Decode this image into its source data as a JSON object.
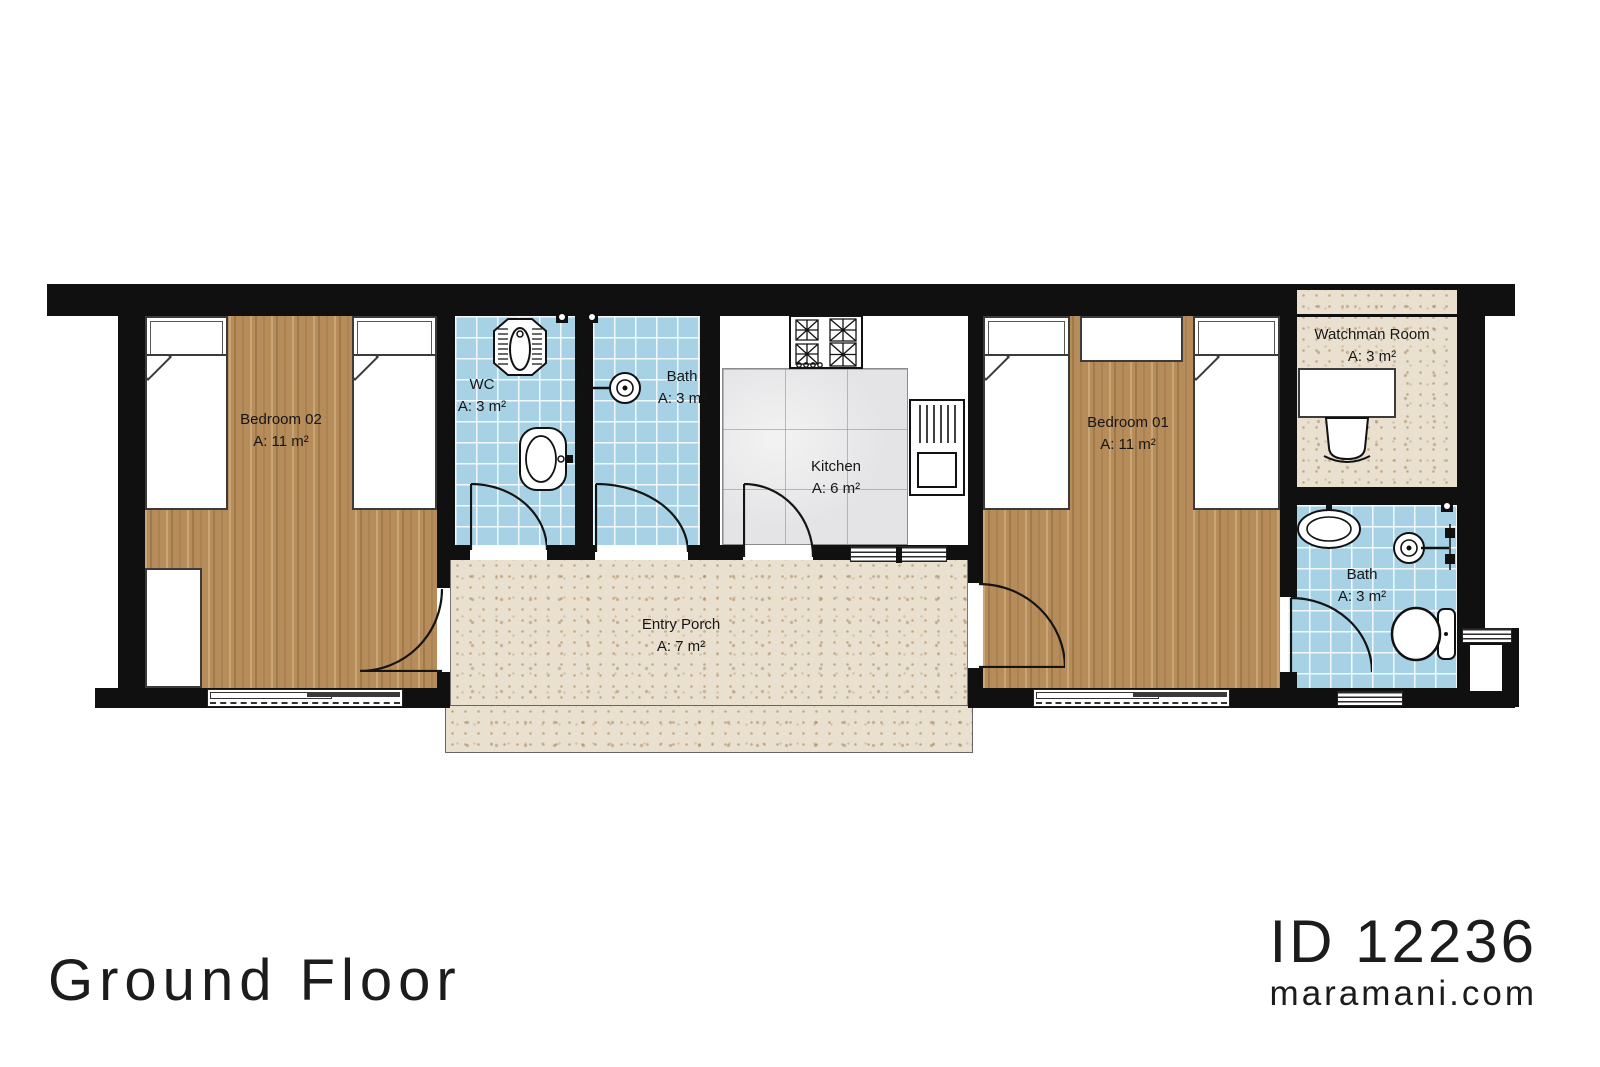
{
  "footer": {
    "title": "Ground Floor",
    "plan_id": "ID 12236",
    "website": "maramani.com"
  },
  "rooms": [
    {
      "id": "bedroom-02",
      "name": "Bedroom 02",
      "area": "A: 11 m²"
    },
    {
      "id": "wc",
      "name": "WC",
      "area": "A: 3 m²"
    },
    {
      "id": "bath",
      "name": "Bath",
      "area": "A: 3 m²"
    },
    {
      "id": "kitchen",
      "name": "Kitchen",
      "area": "A: 6 m²"
    },
    {
      "id": "bedroom-01",
      "name": "Bedroom 01",
      "area": "A: 11 m²"
    },
    {
      "id": "watchman-room",
      "name": "Watchman Room",
      "area": "A: 3 m²"
    },
    {
      "id": "bath-2",
      "name": "Bath",
      "area": "A: 3 m²"
    },
    {
      "id": "entry-porch",
      "name": "Entry Porch",
      "area": "A: 7 m²"
    }
  ],
  "colors": {
    "wall": "#101010",
    "wood_floor": "#b58c5a",
    "tile_floor": "#a7d2e5",
    "speckle_floor": "#eae0cf",
    "marble_floor": "#e4e4e6",
    "background": "#ffffff"
  }
}
